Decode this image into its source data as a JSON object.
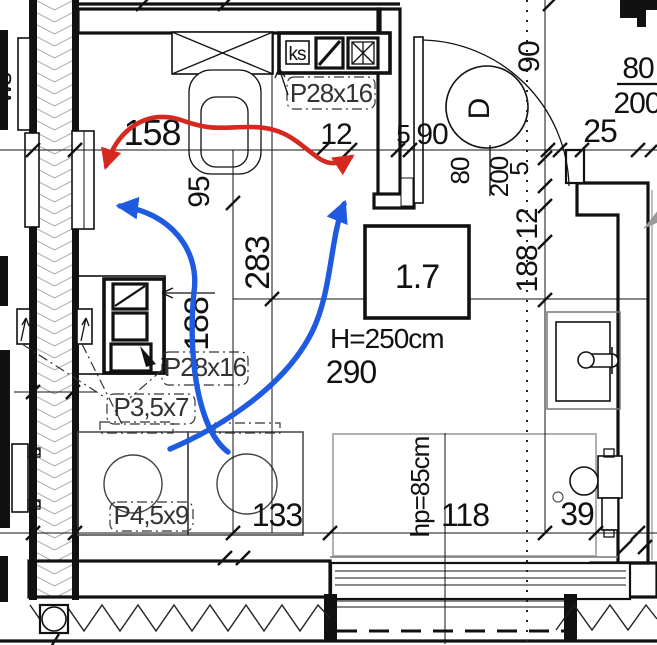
{
  "plan": {
    "room_box": {
      "number": "1.7"
    },
    "texts": {
      "height_label": "H=250cm",
      "dim_290": "290",
      "dim_158": "158",
      "dim_12_top": "12",
      "dim_5_top": "5",
      "dim_90_top": "90",
      "dim_25": "25",
      "door_letter": "D",
      "door_dim_90": "90",
      "door_size_80": "80",
      "door_size_200": "200",
      "tr_size_80": "80",
      "tr_size_200": "200",
      "dim_5_right": "5",
      "dim_12_right": "12",
      "dim_188_right": "188",
      "dim_95": "95",
      "dim_283": "283",
      "dim_188_mid": "188",
      "dim_133": "133",
      "dim_118": "118",
      "dim_39": "39",
      "window_sill_label": "hp=85cm",
      "label_ks": "ks",
      "label_p28_top": "P28x16",
      "label_p28_mid": "P28x16",
      "label_p35": "P3,5x7",
      "label_p45": "P4,5x9",
      "label_ws": "ws"
    },
    "colors": {
      "red_arrow": "#d6281e",
      "blue_arrow": "#1f5be0",
      "line": "#111111",
      "hatch": "#9a9a9a"
    }
  }
}
